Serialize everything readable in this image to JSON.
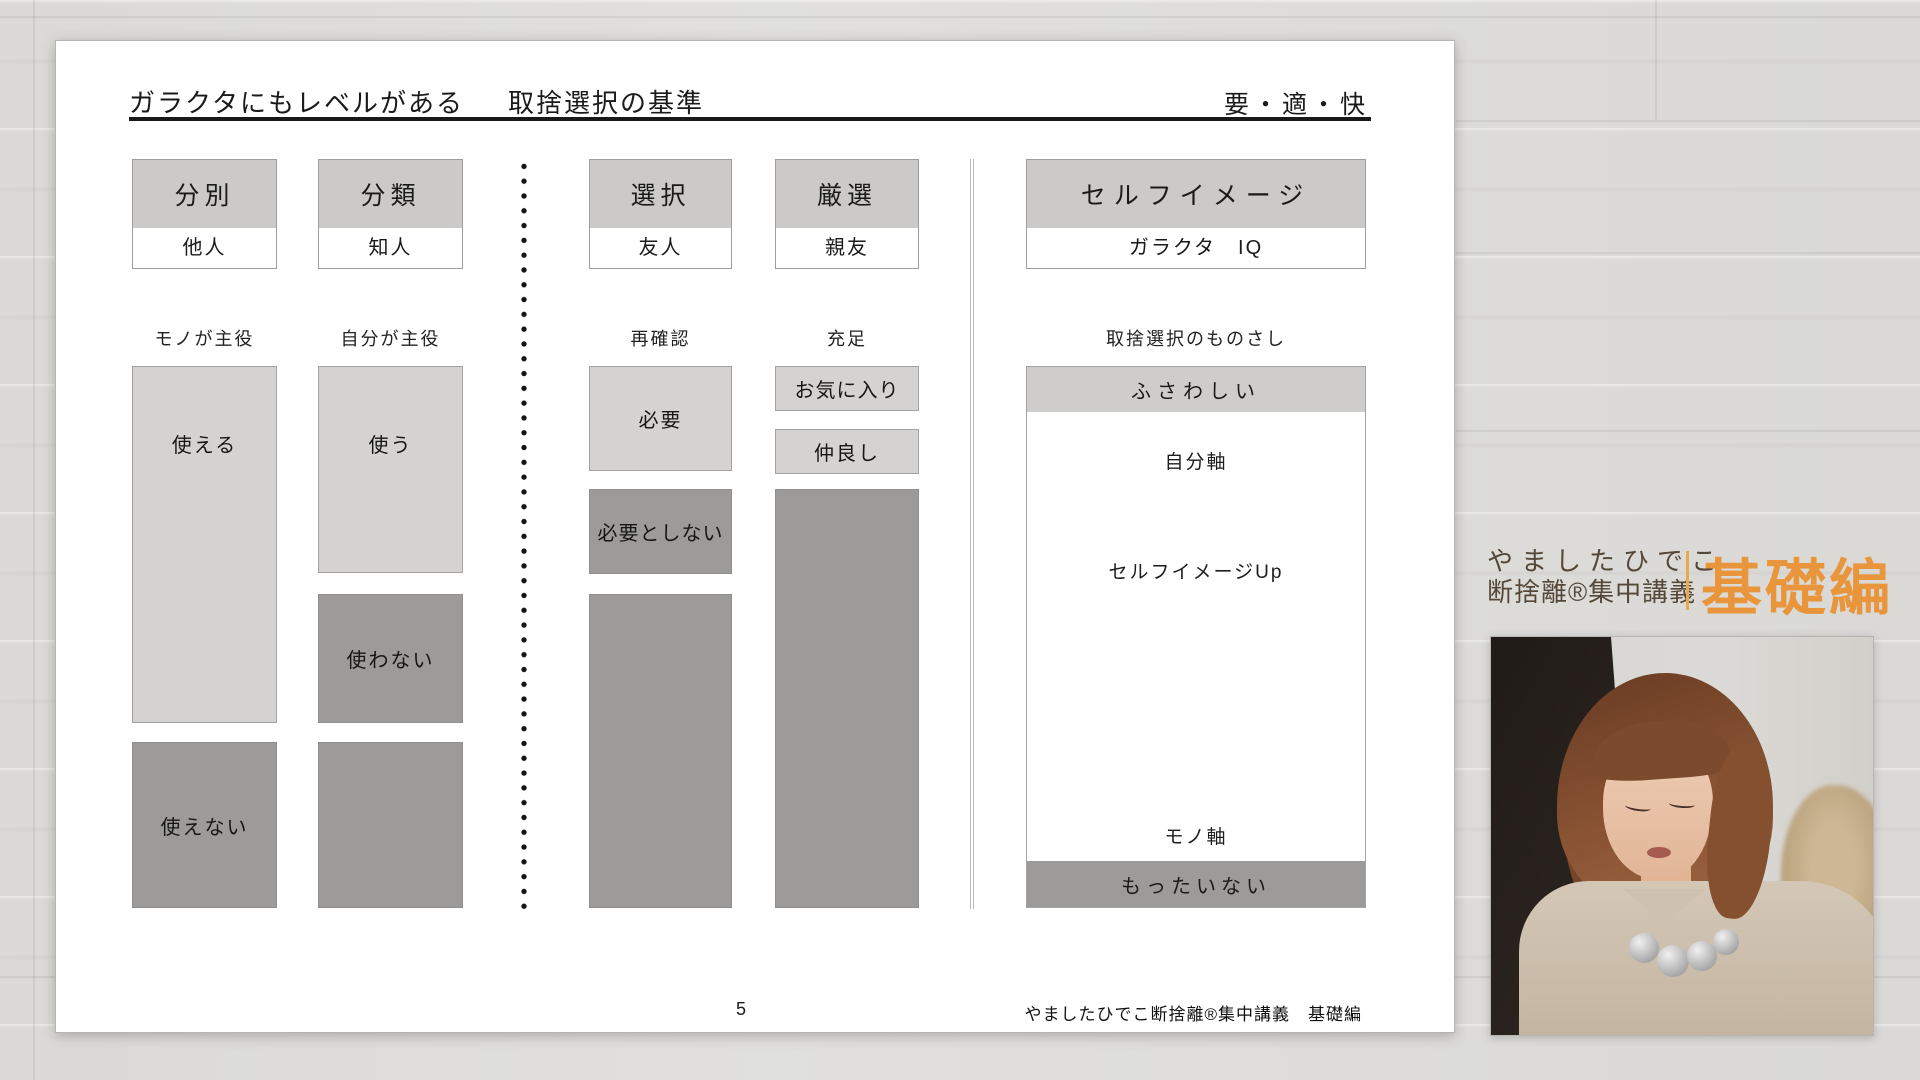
{
  "slide": {
    "title": {
      "part1": "ガラクタにもレベルがある",
      "part2": "取捨選択の基準",
      "right": "要・適・快"
    },
    "columns": [
      {
        "header": "分別",
        "owner": "他人",
        "role_label": "モノが主役",
        "boxes": [
          {
            "text": "使える",
            "tone": "light"
          },
          {
            "text": "使えない",
            "tone": "dark"
          }
        ]
      },
      {
        "header": "分類",
        "owner": "知人",
        "role_label": "自分が主役",
        "boxes": [
          {
            "text": "使う",
            "tone": "light"
          },
          {
            "text": "使わない",
            "tone": "dark"
          },
          {
            "text": "",
            "tone": "dark"
          }
        ]
      },
      {
        "header": "選択",
        "owner": "友人",
        "role_label": "再確認",
        "boxes": [
          {
            "text": "必要",
            "tone": "light"
          },
          {
            "text": "必要としない",
            "tone": "dark"
          },
          {
            "text": "",
            "tone": "dark"
          }
        ]
      },
      {
        "header": "厳選",
        "owner": "親友",
        "role_label": "充足",
        "boxes": [
          {
            "text": "お気に入り",
            "tone": "light"
          },
          {
            "text": "仲良し",
            "tone": "light"
          },
          {
            "text": "",
            "tone": "dark"
          }
        ]
      }
    ],
    "self_image": {
      "header": "セルフイメージ",
      "owner": "ガラクタ　IQ",
      "role_label": "取捨選択のものさし",
      "top_band": "ふさわしい",
      "axis_top": "自分軸",
      "axis_middle": "セルフイメージUp",
      "axis_bottom": "モノ軸",
      "bottom_band": "もったいない"
    },
    "footer": {
      "page_number": "5",
      "credit": "やましたひでこ断捨離®集中講義　基礎編"
    }
  },
  "branding": {
    "line1": "やましたひでこ",
    "line2": "断捨離®集中講義",
    "edition": "基礎編"
  },
  "colors": {
    "accent_orange": "#e8953b",
    "brand_brown": "#554839",
    "box_header_grey": "#cbcac8",
    "box_light_grey": "#d4d3d1",
    "box_dark_grey": "#9c9b99",
    "page_background": "#dfdedb"
  }
}
